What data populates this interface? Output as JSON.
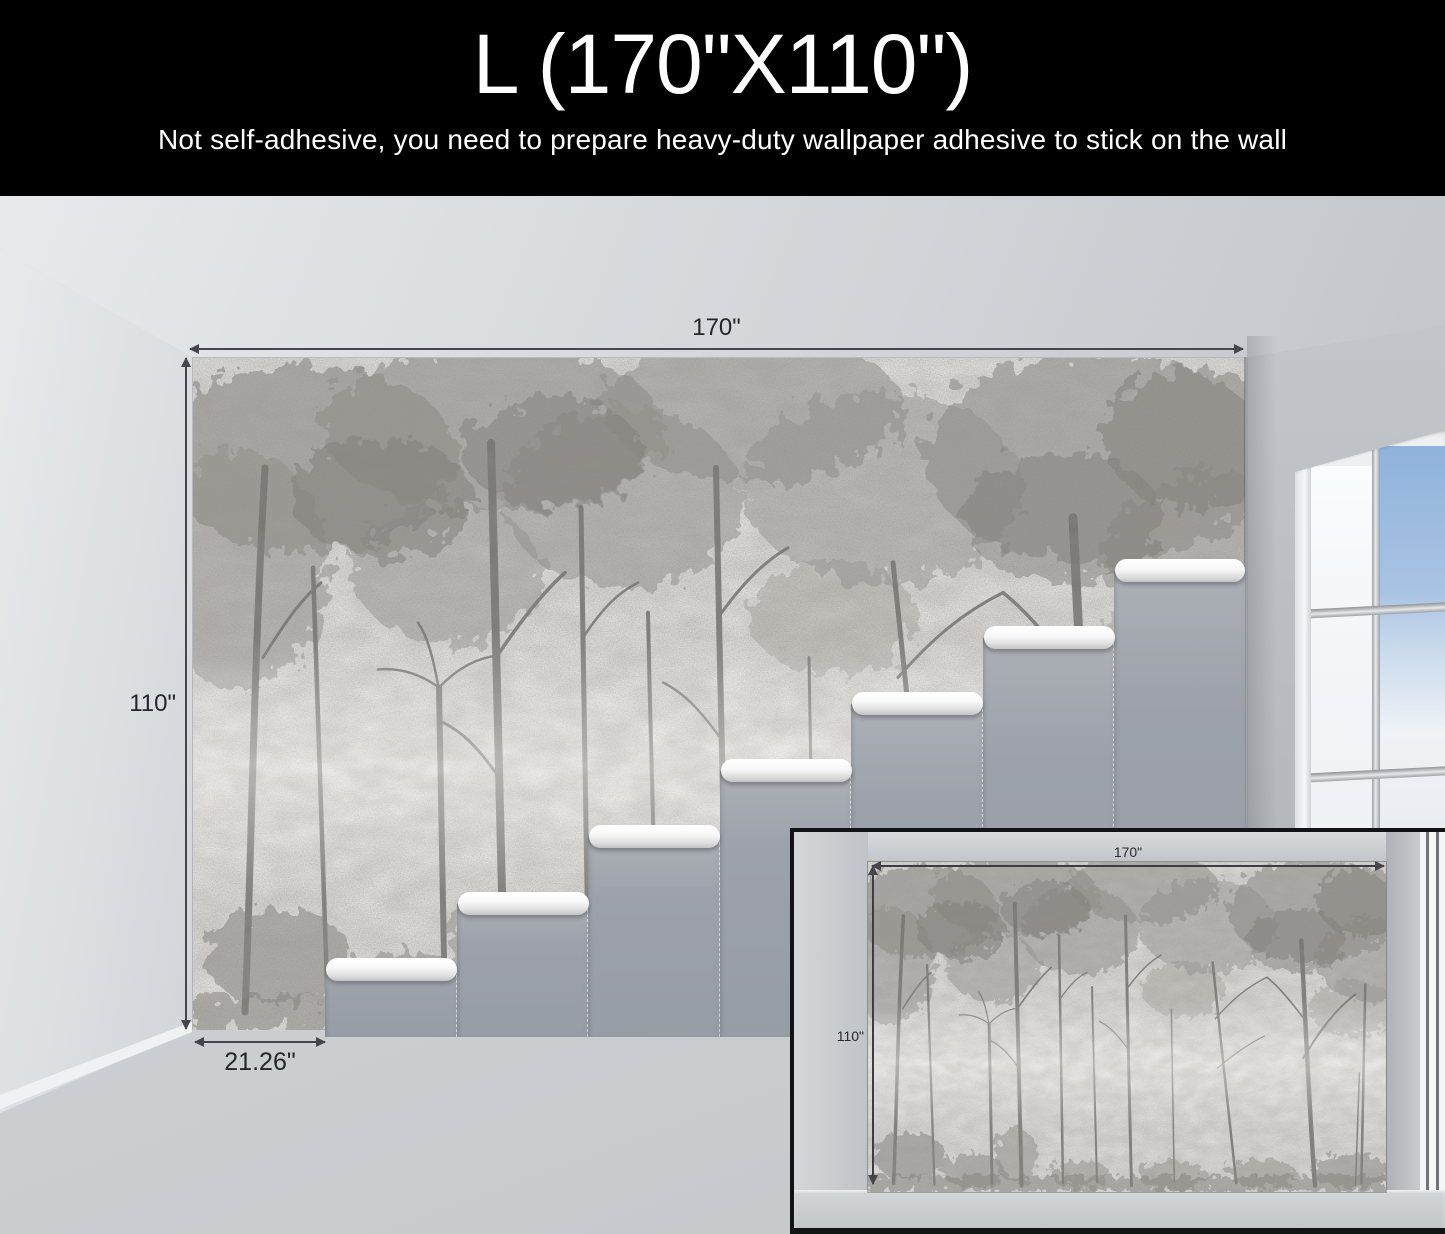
{
  "header": {
    "size_label": "L (170\"X110\")",
    "note": "Not self-adhesive, you need to prepare heavy-duty wallpaper adhesive to stick on the wall"
  },
  "dimensions": {
    "wall_width": "170\"",
    "wall_height": "110\"",
    "panel_width": "21.26\""
  },
  "inset": {
    "wall_width": "170\"",
    "wall_height": "110\""
  },
  "colors": {
    "header_bg": "#000000",
    "header_text": "#ffffff",
    "dimension_text": "#26262a",
    "stair_gray": "#9da2aa",
    "tread_white": "#ffffff",
    "sky_blue": "#8fb2dc",
    "mural_base": "#c7c5c1"
  }
}
